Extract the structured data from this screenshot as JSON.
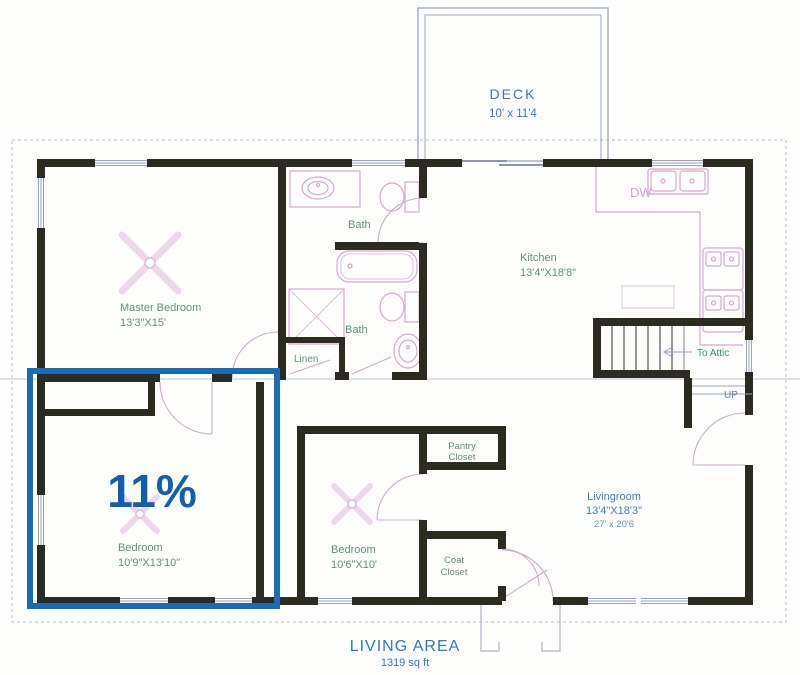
{
  "highlight": {
    "percent_label": "11%",
    "box_color": "#1a6bb5",
    "text_color": "#115fae"
  },
  "rooms": {
    "deck": {
      "name": "DECK",
      "dims": "10' x 11'4"
    },
    "master_bedroom": {
      "name": "Master Bedroom",
      "dims": "13'3\"X15'"
    },
    "bath_upper": {
      "name": "Bath"
    },
    "bath_lower": {
      "name": "Bath"
    },
    "linen": {
      "name": "Linen"
    },
    "kitchen": {
      "name": "Kitchen",
      "dims": "13'4\"X18'8\""
    },
    "stairs": {
      "to_attic": "To Attic",
      "up": "UP"
    },
    "dishwasher": "DW",
    "bedroom_highlighted": {
      "name": "Bedroom",
      "dims": "10'9\"X13'10\""
    },
    "bedroom_middle": {
      "name": "Bedroom",
      "dims": "10'6\"X10'"
    },
    "pantry_closet": {
      "line1": "Pantry",
      "line2": "Closet"
    },
    "coat_closet": {
      "line1": "Coat",
      "line2": "Closet"
    },
    "livingroom": {
      "name": "Livingroom",
      "dims": "13'4\"X18'3\"",
      "dims2": "27' x 20'6"
    }
  },
  "footer": {
    "title": "LIVING AREA",
    "subtitle": "1319 sq ft"
  },
  "colors": {
    "walls": "#2c2b21",
    "room_labels": "#649077",
    "blue_labels": "#3f7fc1",
    "fixtures": "#d8a9d2"
  }
}
